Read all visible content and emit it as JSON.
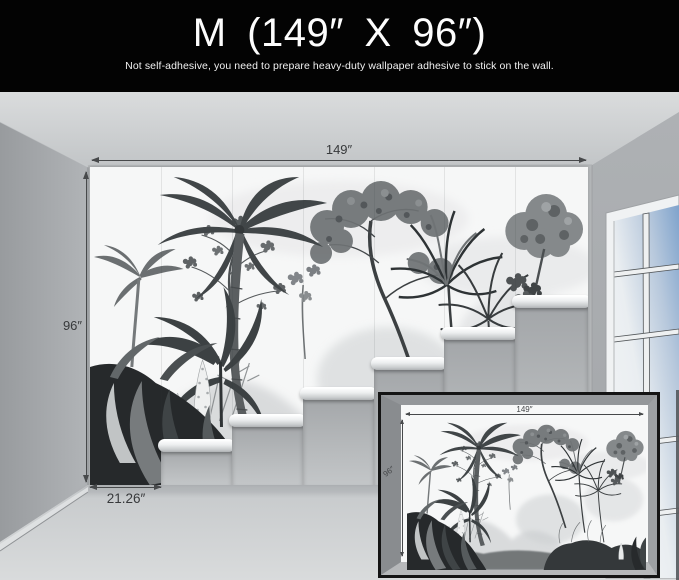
{
  "header": {
    "title": "M (149″ X 96″)",
    "subtitle": "Not self-adhesive, you need to prepare heavy-duty wallpaper adhesive to stick on the wall."
  },
  "mural_dimensions": {
    "width": "149″",
    "height": "96″",
    "panel_width": "21.26″"
  },
  "inset_preview": {
    "width": "149″",
    "height": "96″"
  },
  "colors": {
    "header_bg": "#030303",
    "header_text": "#ffffff",
    "dimension_text": "#37393b",
    "wall_gray": "#b5b8ba",
    "sky_blue": "#7fa3cc"
  }
}
